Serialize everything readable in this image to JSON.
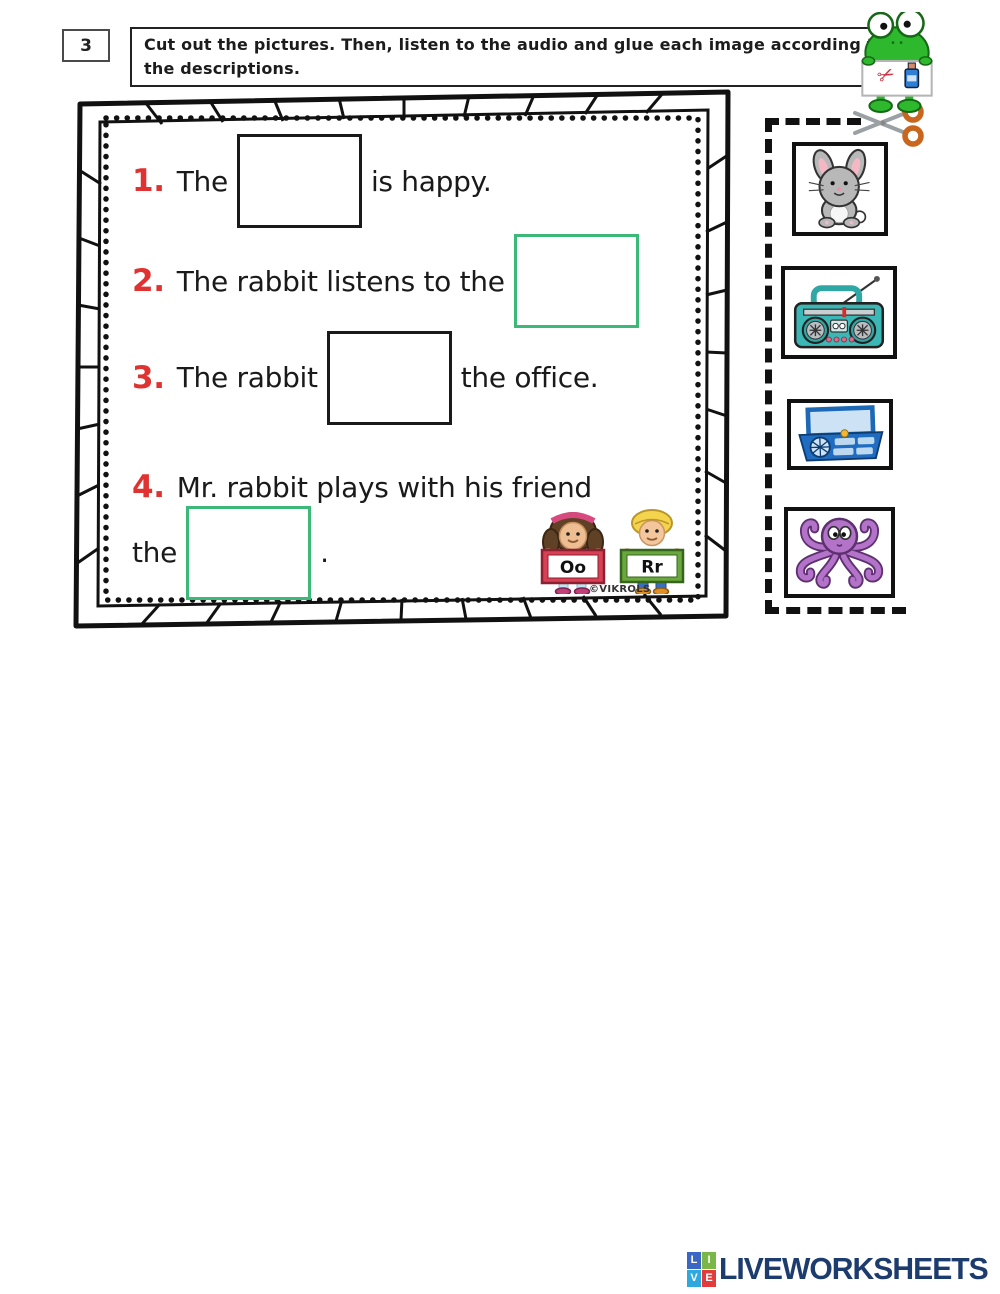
{
  "header": {
    "exercise_number": "3",
    "instruction_line1": "Cut out the pictures. Then, listen to the audio and glue each image according to",
    "instruction_line2": "the descriptions."
  },
  "worksheet": {
    "sentences": [
      {
        "number": "1.",
        "before": "The",
        "after": "is happy.",
        "blank_style": "black"
      },
      {
        "number": "2.",
        "before": "The rabbit listens to the",
        "after": "",
        "blank_style": "green"
      },
      {
        "number": "3.",
        "before": "The rabbit",
        "after": "the office.",
        "blank_style": "black"
      },
      {
        "number": "4.",
        "line1": "Mr. rabbit plays with his friend",
        "before": "the",
        "after": ".",
        "blank_style": "green"
      }
    ],
    "letter_cards": [
      {
        "label": "Oo"
      },
      {
        "label": "Rr"
      }
    ],
    "credit": "©VIKROLS"
  },
  "cutout_panel": {
    "images": [
      {
        "name": "rabbit"
      },
      {
        "name": "radio"
      },
      {
        "name": "office"
      },
      {
        "name": "octopus"
      }
    ]
  },
  "footer": {
    "logo_letters": [
      "L",
      "I",
      "V",
      "E"
    ],
    "logo_text": "LIVEWORKSHEETS"
  },
  "colors": {
    "number_red": "#e03230",
    "blank_black": "#1a1a1a",
    "blank_green": "#3cb878",
    "frog_green": "#2eb82e",
    "radio_teal": "#3bb8b5",
    "office_blue": "#1f6cc0",
    "octopus_purple": "#b273c9",
    "scissors_handle_orange": "#c9651d",
    "logo_navy": "#1d3c6e"
  }
}
